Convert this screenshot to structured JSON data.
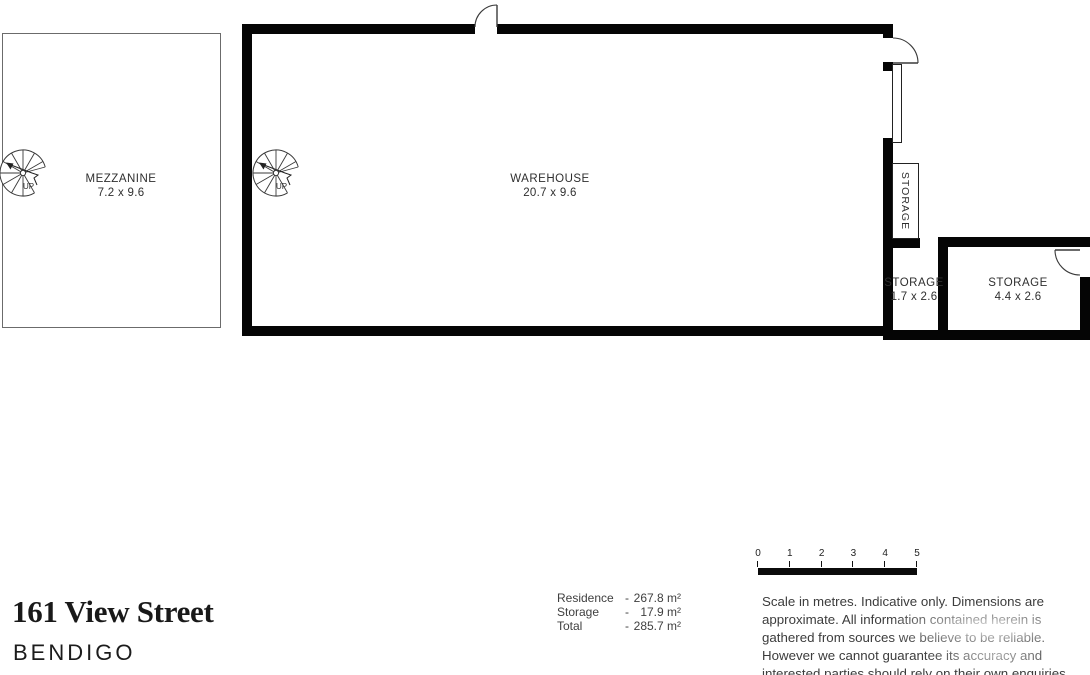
{
  "plan": {
    "mezzanine": {
      "name": "MEZZANINE",
      "dims": "7.2 x 9.6"
    },
    "warehouse": {
      "name": "WAREHOUSE",
      "dims": "20.7 x 9.6"
    },
    "storage_closet": {
      "name": "STORAGE"
    },
    "storage_small": {
      "name": "STORAGE",
      "dims": "1.7 x 2.6"
    },
    "storage_large": {
      "name": "STORAGE",
      "dims": "4.4 x 2.6"
    },
    "stairs_label": "UP"
  },
  "scale_bar": {
    "ticks": [
      "0",
      "1",
      "2",
      "3",
      "4",
      "5"
    ]
  },
  "areas": {
    "rows": [
      {
        "label": "Residence",
        "dash": "-",
        "value": "267.8 m²"
      },
      {
        "label": "Storage",
        "dash": "-",
        "value": "17.9 m²"
      },
      {
        "label": "Total",
        "dash": "-",
        "value": "285.7 m²"
      }
    ]
  },
  "address": {
    "street": "161 View Street",
    "suburb": "BENDIGO"
  },
  "disclaimer": {
    "lines": [
      "Scale in metres. Indicative only. Dimensions are",
      "approximate. All information contained herein is",
      "gathered from sources we believe to be reliable.",
      "However we cannot guarantee its accuracy and",
      "interested parties should rely on their own enquiries."
    ]
  },
  "colors": {
    "wall": "#000000",
    "thin_line": "#3a3a3a",
    "body_text": "#3c3c3c",
    "title_text": "#1a1a1a"
  }
}
